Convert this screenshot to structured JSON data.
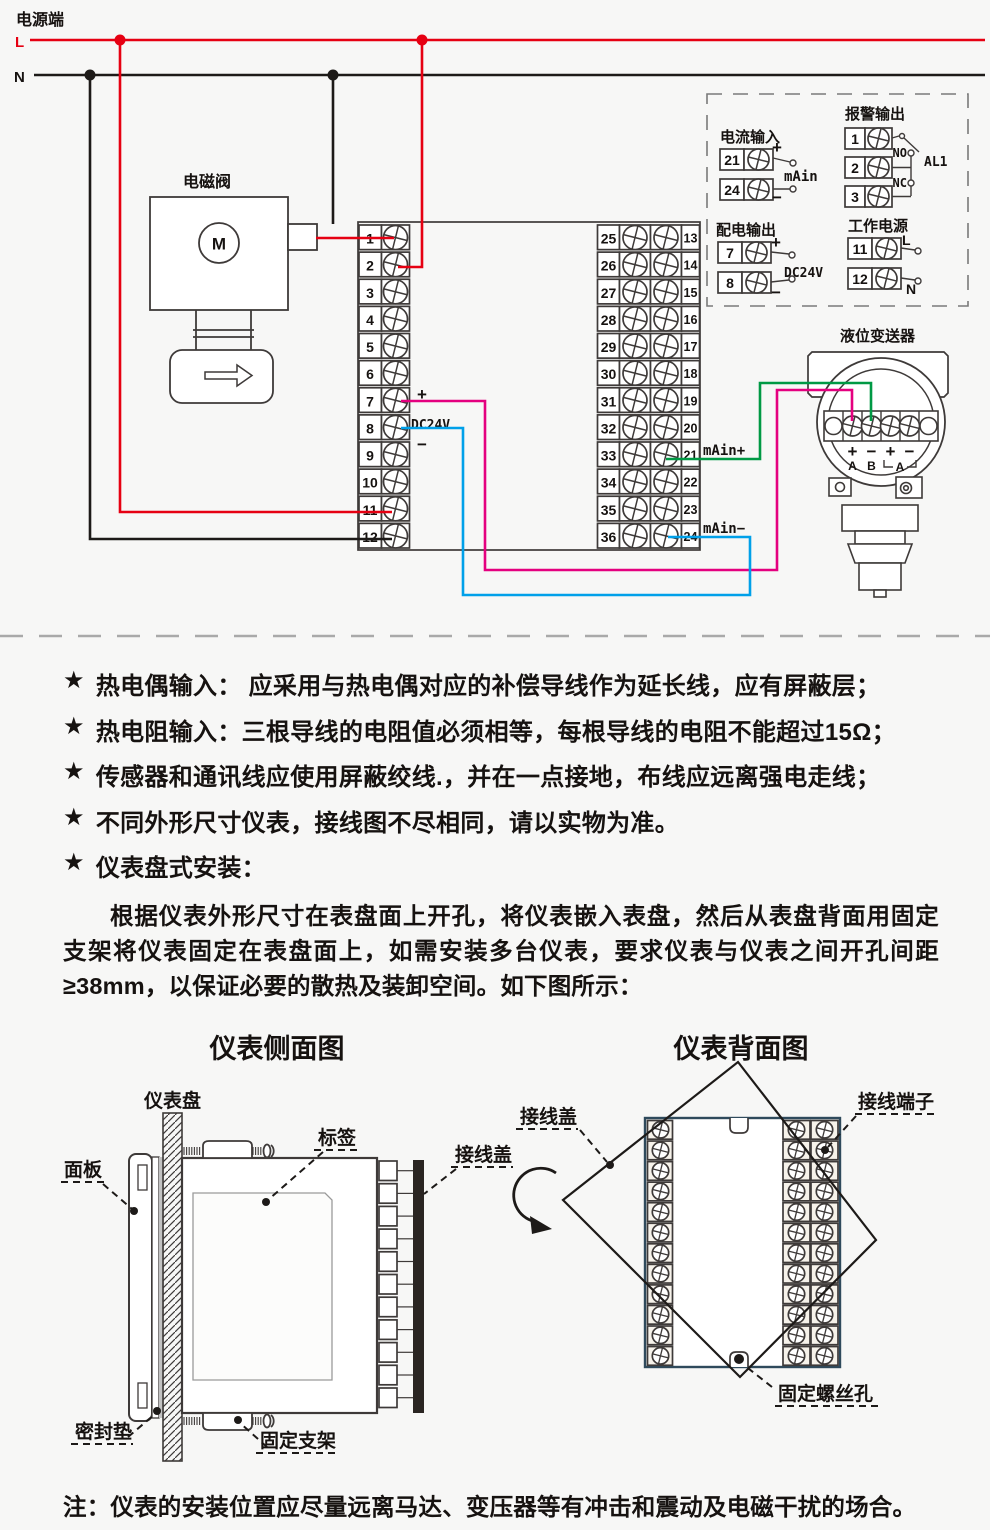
{
  "colors": {
    "red": "#e60012",
    "dark": "#3e3a39",
    "ink": "#1d1a18",
    "magenta": "#e4007f",
    "cyan": "#00a0e9",
    "green": "#009944",
    "dash_gray": "#a9a9a9",
    "back_outline": "#2f4a5c",
    "bar_black": "#2a2522",
    "gasket_gray": "#c2c2c2"
  },
  "power": {
    "title": "电源端",
    "l": "L",
    "n": "N"
  },
  "solenoid": {
    "label": "电磁阀",
    "m": "M"
  },
  "main_unit": {
    "left_terminals": [
      "1",
      "2",
      "3",
      "4",
      "5",
      "6",
      "7",
      "8",
      "9",
      "10",
      "11",
      "12"
    ],
    "right_terminals_outer": [
      "25",
      "26",
      "27",
      "28",
      "29",
      "30",
      "31",
      "32",
      "33",
      "34",
      "35",
      "36"
    ],
    "right_terminals_inner": [
      "13",
      "14",
      "15",
      "16",
      "17",
      "18",
      "19",
      "20",
      "21",
      "22",
      "23",
      "24"
    ],
    "plus": "+",
    "minus": "−",
    "dc24v": "DC24V",
    "main_plus": "mAin+",
    "main_minus": "mAin−"
  },
  "inset": {
    "current_input": {
      "title": "电流输入",
      "terminals": [
        "21",
        "24"
      ],
      "plus": "+",
      "minus": "−",
      "label": "mAin"
    },
    "alarm_output": {
      "title": "报警输出",
      "terminals": [
        "1",
        "2",
        "3"
      ],
      "no": "NO",
      "nc": "NC",
      "al1": "AL1"
    },
    "dist_output": {
      "title": "配电输出",
      "terminals": [
        "7",
        "8"
      ],
      "plus": "+",
      "minus": "−",
      "label": "DC24V"
    },
    "work_power": {
      "title": "工作电源",
      "terminals": [
        "11",
        "12"
      ],
      "l": "L",
      "n": "N"
    }
  },
  "transmitter": {
    "title": "液位变送器",
    "signs": [
      "+",
      "−",
      "+",
      "−"
    ],
    "a": "A",
    "b": "B",
    "bracket_a": "A"
  },
  "notes": {
    "star": "★",
    "items": [
      "热电偶输入： 应采用与热电偶对应的补偿导线作为延长线，应有屏蔽层；",
      "热电阻输入：三根导线的电阻值必须相等，每根导线的电阻不能超过15Ω；",
      "传感器和通讯线应使用屏蔽绞线.，并在一点接地，布线应远离强电走线；",
      "不同外形尺寸仪表，接线图不尽相同，请以实物为准。",
      "仪表盘式安装："
    ]
  },
  "install_paragraph": "根据仪表外形尺寸在表盘面上开孔，将仪表嵌入表盘，然后从表盘背面用固定支架将仪表固定在表盘面上，如需安装多台仪表，要求仪表与仪表之间开孔间距≥38mm，以保证必要的散热及装卸空间。如下图所示：",
  "side_view": {
    "title": "仪表侧面图",
    "labels": {
      "panel": "仪表盘",
      "front_panel": "面板",
      "tag": "标签",
      "cover": "接线盖",
      "gasket": "密封垫",
      "bracket": "固定支架"
    }
  },
  "back_view": {
    "title": "仪表背面图",
    "labels": {
      "cover": "接线盖",
      "terminals": "接线端子",
      "screw_hole": "固定螺丝孔"
    }
  },
  "bottom_note": "注：仪表的安装位置应尽量远离马达、变压器等有冲击和震动及电磁干扰的场合。"
}
